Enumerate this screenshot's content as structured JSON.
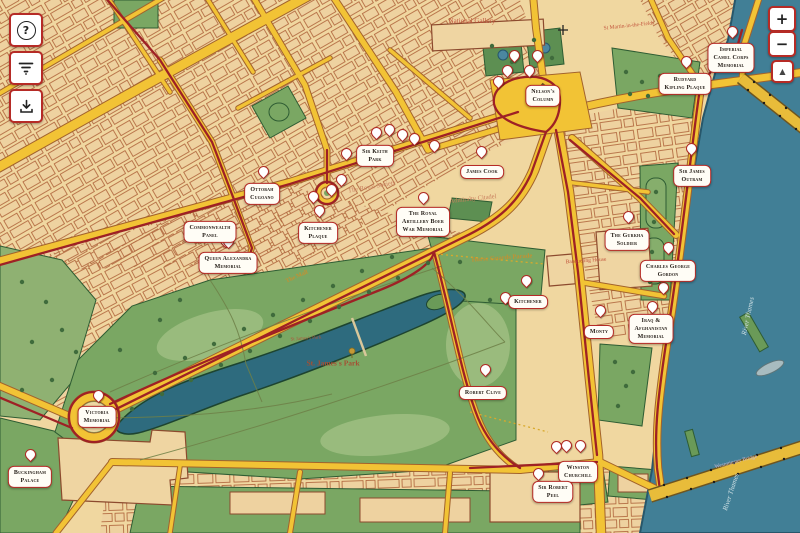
{
  "colors": {
    "accent_red": "#b62b26",
    "route_red": "#9e2125",
    "road_yellow": "#f2c335",
    "park_green": "#7aa763",
    "water_teal": "#417f96",
    "base_tan": "#f0d7a0"
  },
  "controls": {
    "help": {
      "glyph": "?",
      "label": "help"
    },
    "filter": {
      "label": "filter"
    },
    "download": {
      "label": "download"
    },
    "zoom_in": {
      "glyph": "+",
      "label": "zoom in"
    },
    "zoom_out": {
      "glyph": "−",
      "label": "zoom out"
    },
    "compass": {
      "glyph": "▲",
      "label": "locate"
    }
  },
  "map": {
    "pois": [
      {
        "id": "nelsons-column",
        "lines": [
          "Nelson's",
          "Column"
        ],
        "x": 543,
        "y": 96
      },
      {
        "id": "imperial-camel-corps-memorial",
        "lines": [
          "Imperial",
          "Camel Corps",
          "Memorial"
        ],
        "x": 731,
        "y": 58
      },
      {
        "id": "rudyard-kipling-plaque",
        "lines": [
          "Rudyard",
          "Kipling Plaque"
        ],
        "x": 685,
        "y": 84
      },
      {
        "id": "sir-james-outram",
        "lines": [
          "Sir James",
          "Outram"
        ],
        "x": 692,
        "y": 176
      },
      {
        "id": "the-gurkha-soldier",
        "lines": [
          "The Gurkha",
          "Soldier"
        ],
        "x": 627,
        "y": 240
      },
      {
        "id": "charles-george-gordon",
        "lines": [
          "Charles George",
          "Gordon"
        ],
        "x": 668,
        "y": 271
      },
      {
        "id": "james-cook",
        "lines": [
          "James Cook"
        ],
        "x": 482,
        "y": 172
      },
      {
        "id": "sir-keith-park",
        "lines": [
          "Sir Keith",
          "Park"
        ],
        "x": 375,
        "y": 156
      },
      {
        "id": "royal-artillery-boer-war-memorial",
        "lines": [
          "The Royal",
          "Artillery Boer",
          "War Memorial"
        ],
        "x": 423,
        "y": 222
      },
      {
        "id": "ottobah-cugoano",
        "lines": [
          "Ottobah",
          "Cugoano"
        ],
        "x": 262,
        "y": 194
      },
      {
        "id": "commonwealth-panel",
        "lines": [
          "Commonwealth",
          "Panel"
        ],
        "x": 210,
        "y": 232
      },
      {
        "id": "kitchener-plaque",
        "lines": [
          "Kitchener",
          "Plaque"
        ],
        "x": 318,
        "y": 233
      },
      {
        "id": "queen-alexandra-memorial",
        "lines": [
          "Queen Alexandra",
          "Memorial"
        ],
        "x": 228,
        "y": 263
      },
      {
        "id": "kitchener",
        "lines": [
          "Kitchener"
        ],
        "x": 528,
        "y": 302
      },
      {
        "id": "monty",
        "lines": [
          "Monty"
        ],
        "x": 599,
        "y": 332
      },
      {
        "id": "iraq-afghanistan-memorial",
        "lines": [
          "Iraq &",
          "Afghanistan",
          "Memorial"
        ],
        "x": 651,
        "y": 329
      },
      {
        "id": "robert-clive",
        "lines": [
          "Robert Clive"
        ],
        "x": 483,
        "y": 393
      },
      {
        "id": "victoria-memorial",
        "lines": [
          "Victoria",
          "Memorial"
        ],
        "x": 97,
        "y": 417
      },
      {
        "id": "buckingham-palace",
        "lines": [
          "Buckingham",
          "Palace"
        ],
        "x": 30,
        "y": 477
      },
      {
        "id": "winston-churchill",
        "lines": [
          "Winston",
          "Churchill"
        ],
        "x": 578,
        "y": 472
      },
      {
        "id": "sir-robert-peel",
        "lines": [
          "Sir Robert",
          "Peel"
        ],
        "x": 553,
        "y": 492
      }
    ],
    "pins": [
      [
        506,
        77
      ],
      [
        528,
        77
      ],
      [
        513,
        62
      ],
      [
        536,
        62
      ],
      [
        497,
        88
      ],
      [
        731,
        38
      ],
      [
        685,
        68
      ],
      [
        690,
        155
      ],
      [
        627,
        223
      ],
      [
        667,
        254
      ],
      [
        480,
        158
      ],
      [
        375,
        139
      ],
      [
        388,
        136
      ],
      [
        401,
        141
      ],
      [
        413,
        145
      ],
      [
        345,
        160
      ],
      [
        433,
        152
      ],
      [
        422,
        204
      ],
      [
        262,
        178
      ],
      [
        224,
        247
      ],
      [
        318,
        217
      ],
      [
        330,
        196
      ],
      [
        340,
        186
      ],
      [
        312,
        203
      ],
      [
        227,
        248
      ],
      [
        504,
        304
      ],
      [
        525,
        287
      ],
      [
        599,
        317
      ],
      [
        651,
        313
      ],
      [
        662,
        294
      ],
      [
        484,
        376
      ],
      [
        97,
        402
      ],
      [
        29,
        461
      ],
      [
        555,
        453
      ],
      [
        565,
        452
      ],
      [
        579,
        452
      ],
      [
        537,
        480
      ]
    ],
    "place_labels": [
      {
        "text": "National Gallery",
        "x": 472,
        "y": 21,
        "rot": 0,
        "size": 7,
        "color": "#c2543c",
        "cls": ""
      },
      {
        "text": "St Martin-in-the-Fields",
        "x": 629,
        "y": 26,
        "rot": -6,
        "size": 5.5,
        "color": "#c2543c",
        "cls": ""
      },
      {
        "text": "The Royal Society",
        "x": 372,
        "y": 187,
        "rot": -10,
        "size": 6.5,
        "color": "#c97f5e",
        "cls": ""
      },
      {
        "text": "Admiralty Citadel",
        "x": 473,
        "y": 199,
        "rot": -6,
        "size": 6.5,
        "color": "#c97f5e",
        "cls": ""
      },
      {
        "text": "Horse Guards Parade",
        "x": 502,
        "y": 258,
        "rot": -4,
        "size": 6.5,
        "color": "#c29133",
        "cls": "b"
      },
      {
        "text": "Banqueting House",
        "x": 586,
        "y": 261,
        "rot": -4,
        "size": 5.5,
        "color": "#c2543c",
        "cls": ""
      },
      {
        "text": "St James's Park",
        "x": 306,
        "y": 339,
        "rot": -4,
        "size": 5,
        "color": "#b0543a",
        "cls": ""
      },
      {
        "text": "St. James's Park",
        "x": 333,
        "y": 363,
        "rot": 0,
        "size": 7.5,
        "color": "#a44f33",
        "cls": "b"
      },
      {
        "text": "The Mall",
        "x": 297,
        "y": 277,
        "rot": -24,
        "size": 6,
        "color": "#c29133",
        "cls": "b"
      },
      {
        "text": "River Thames",
        "x": 748,
        "y": 316,
        "rot": -78,
        "size": 7,
        "color": "#cfe0e4",
        "cls": "i"
      },
      {
        "text": "River Thames",
        "x": 731,
        "y": 492,
        "rot": -72,
        "size": 7,
        "color": "#cfe0e4",
        "cls": "i"
      },
      {
        "text": "Westminster Bridge",
        "x": 736,
        "y": 462,
        "rot": -14,
        "size": 5.5,
        "color": "#cbb8d6",
        "cls": ""
      }
    ]
  }
}
